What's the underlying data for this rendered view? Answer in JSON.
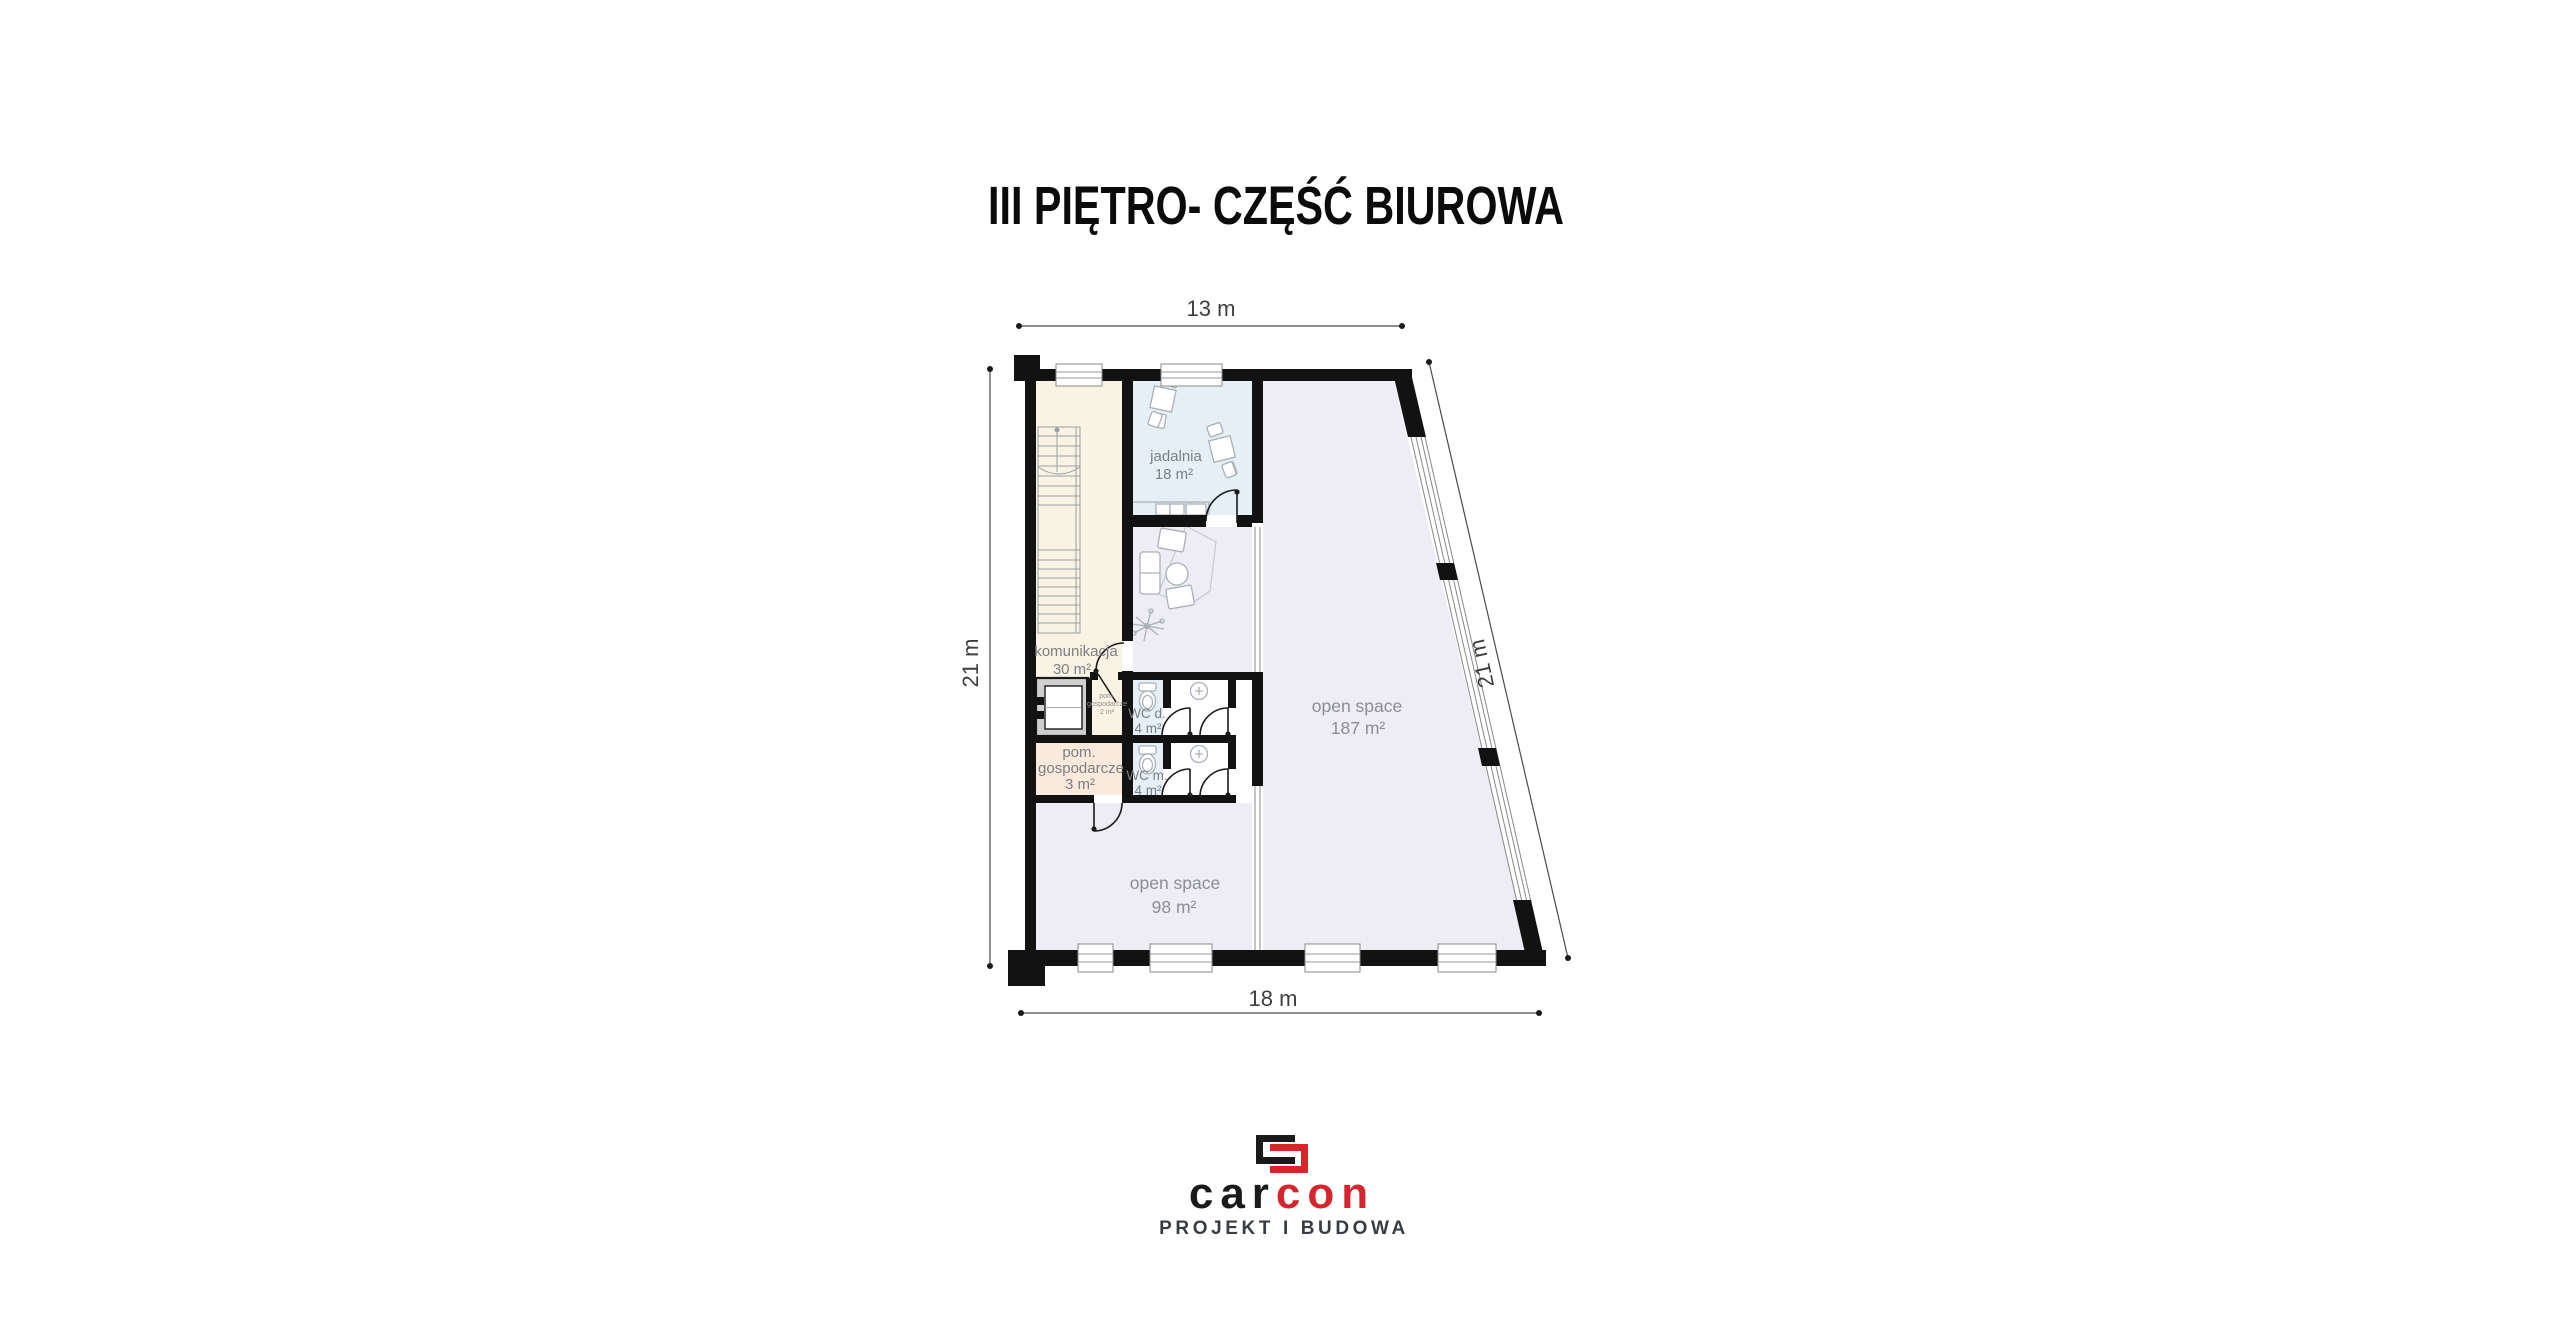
{
  "title": "III PIĘTRO- CZĘŚĆ BIUROWA",
  "dimensions": {
    "top": "13 m",
    "left": "21 m",
    "right": "21 m",
    "bottom": "18 m"
  },
  "rooms": {
    "komunikacja": {
      "name": "komunikacja",
      "area": "30 m²"
    },
    "jadalnia": {
      "name": "jadalnia",
      "area": "18 m²"
    },
    "wc_d": {
      "name": "WC d.",
      "area": "4 m²"
    },
    "wc_m": {
      "name": "WC m.",
      "area": "4 m²"
    },
    "pom_gospodarcze_male": {
      "line1": "pom.",
      "line2": "gospodarcze",
      "line3": "2 m²"
    },
    "pom_gospodarcze": {
      "line1": "pom.",
      "line2": "gospodarcze",
      "line3": "3 m²"
    },
    "open_space_duzy": {
      "name": "open space",
      "area": "187 m²"
    },
    "open_space_maly": {
      "name": "open space",
      "area": "98 m²"
    }
  },
  "logo": {
    "word_black": "car",
    "word_red": "con",
    "tagline": "PROJEKT I BUDOWA"
  },
  "colors": {
    "wall": "#121212",
    "open_space_fill": "#ededf3",
    "stairwell_fill": "#f8f3e2",
    "dining_fill": "#e4f0f6",
    "utility_fill": "#faeadb",
    "logo_red": "#d6252b",
    "logo_black": "#1a1a1a"
  }
}
